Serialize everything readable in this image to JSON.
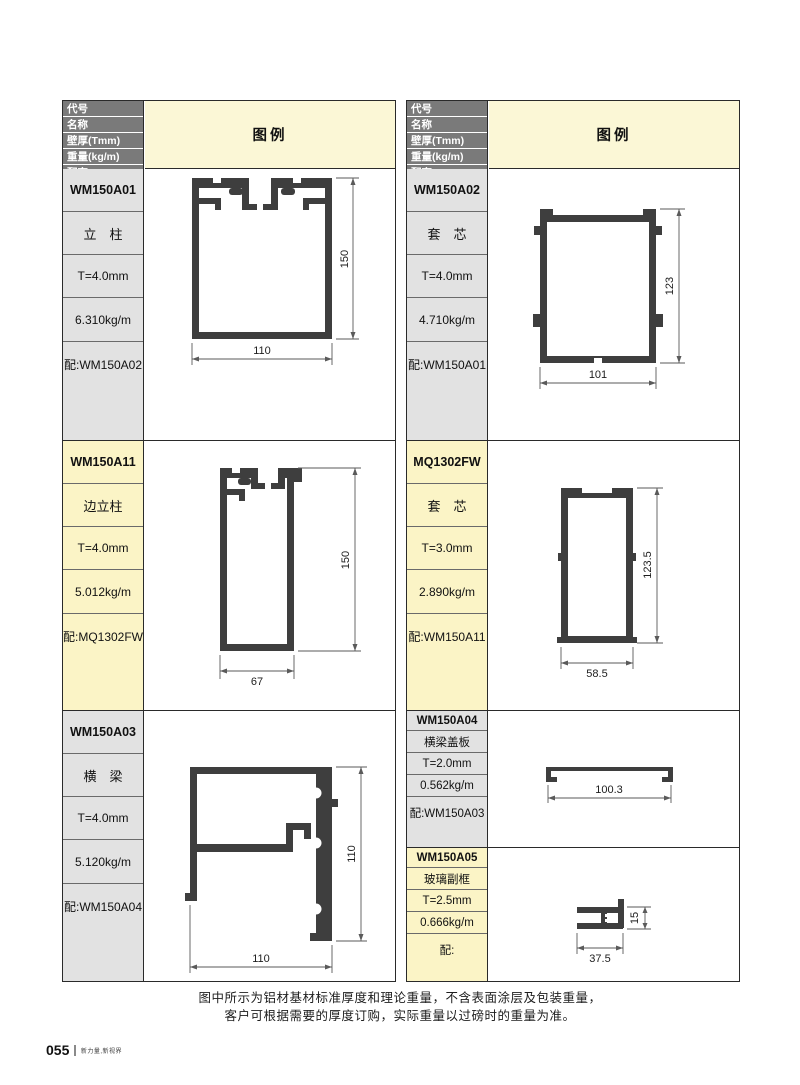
{
  "page": {
    "footer_note": {
      "line1": "图中所示为铝材基材标准厚度和理论重量，不含表面涂层及包装重量，",
      "line2": "客户可根据需要的厚度订购，实际重量以过磅时的重量为准。"
    },
    "page_number": "055",
    "slogan": "新力量,新视界"
  },
  "table_header": {
    "row_labels": [
      "代号",
      "名称",
      "壁厚(Tmm)",
      "重量(kg/m)",
      "配套"
    ],
    "legend_label": "图例"
  },
  "colors": {
    "header_bar": "#7a7a7a",
    "legend_bg": "#fbf7d6",
    "row_gray_bg": "#e2e2e2",
    "row_yellow_bg": "#fbf4c6",
    "profile_fill": "#3e3e3e"
  },
  "tables": [
    {
      "side": "left",
      "rows": [
        {
          "code": "WM150A01",
          "name": "立　柱",
          "thickness": "T=4.0mm",
          "weight": "6.310kg/m",
          "match": "配:WM150A02",
          "dims": {
            "width": "110",
            "height": "150"
          }
        },
        {
          "code": "WM150A11",
          "name": "边立柱",
          "thickness": "T=4.0mm",
          "weight": "5.012kg/m",
          "match": "配:MQ1302FW",
          "dims": {
            "width": "67",
            "height": "150"
          }
        },
        {
          "code": "WM150A03",
          "name": "横　梁",
          "thickness": "T=4.0mm",
          "weight": "5.120kg/m",
          "match": "配:WM150A04",
          "dims": {
            "width": "110",
            "height": "110"
          }
        }
      ]
    },
    {
      "side": "right",
      "rows": [
        {
          "code": "WM150A02",
          "name": "套　芯",
          "thickness": "T=4.0mm",
          "weight": "4.710kg/m",
          "match": "配:WM150A01",
          "dims": {
            "width": "101",
            "height": "123"
          }
        },
        {
          "code": "MQ1302FW",
          "name": "套　芯",
          "thickness": "T=3.0mm",
          "weight": "2.890kg/m",
          "match": "配:WM150A11",
          "dims": {
            "width": "58.5",
            "height": "123.5"
          }
        },
        {
          "code": "WM150A04",
          "name": "横梁盖板",
          "thickness": "T=2.0mm",
          "weight": "0.562kg/m",
          "match": "配:WM150A03",
          "dims": {
            "width": "100.3"
          }
        },
        {
          "code": "WM150A05",
          "name": "玻璃副框",
          "thickness": "T=2.5mm",
          "weight": "0.666kg/m",
          "match": "配:",
          "dims": {
            "width": "37.5",
            "height": "15"
          }
        }
      ]
    }
  ]
}
